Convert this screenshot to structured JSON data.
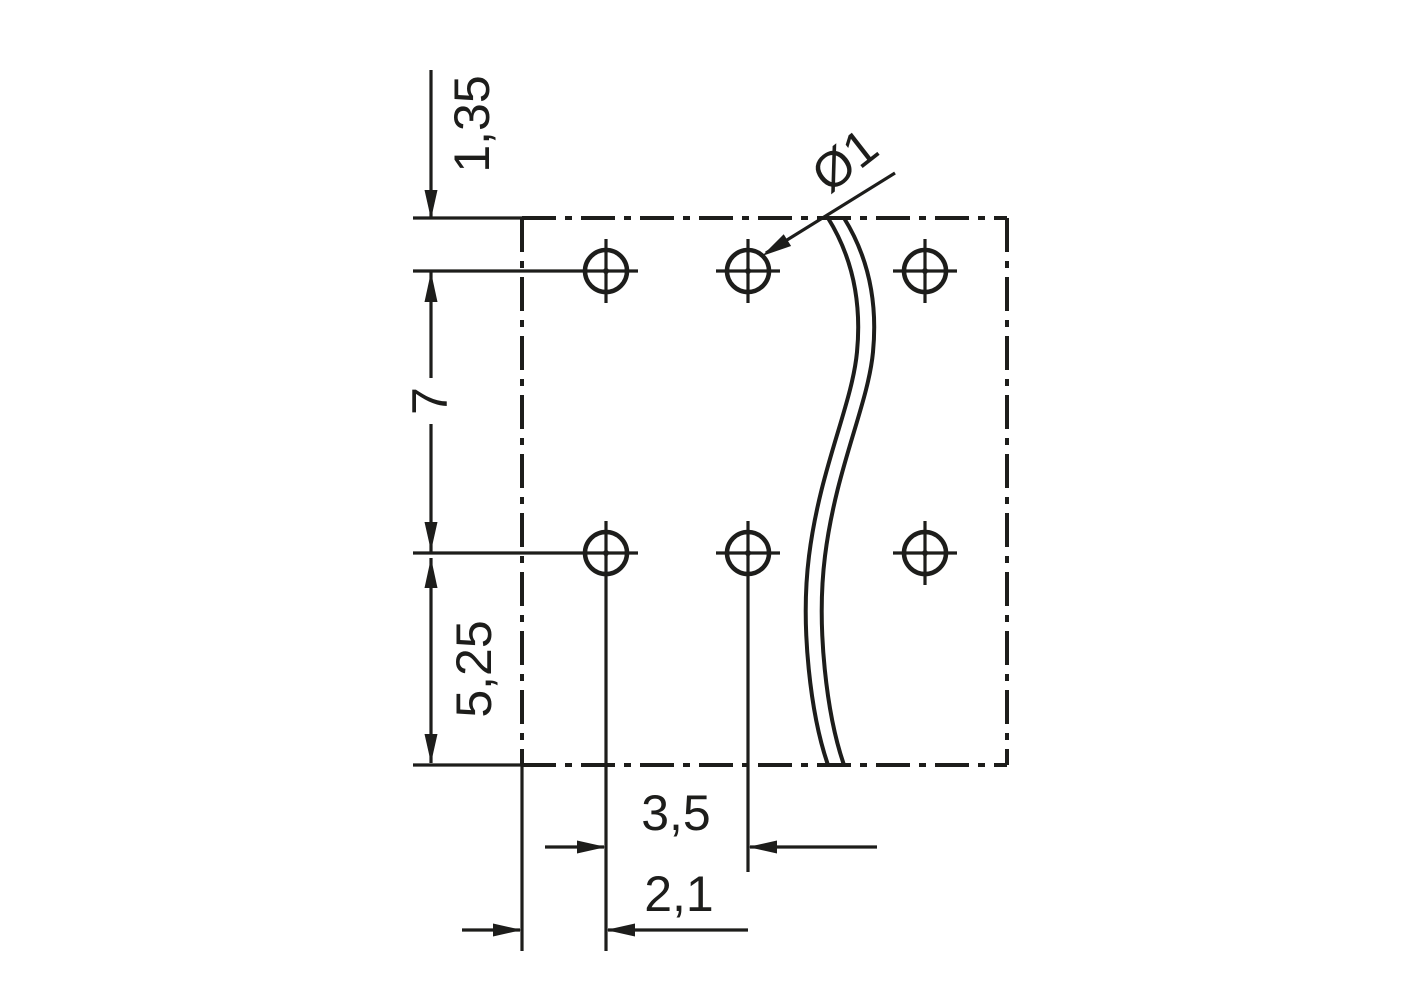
{
  "drawing": {
    "description": "Technical drilling plan / footprint drawing with two rows of mounting holes and a break line",
    "background_color": "#ffffff",
    "line_color": "#1d1d1b",
    "units": "mm",
    "dimensions": {
      "top_edge_to_row": "1,35",
      "row_pitch": "7",
      "row_to_bottom_edge": "5,25",
      "hole_pitch": "3,5",
      "edge_to_first_hole": "2,1",
      "hole_diameter": "Ø1"
    },
    "holes": {
      "rows": 2,
      "columns_shown": 3,
      "marker": "circle-with-crosshair"
    }
  }
}
